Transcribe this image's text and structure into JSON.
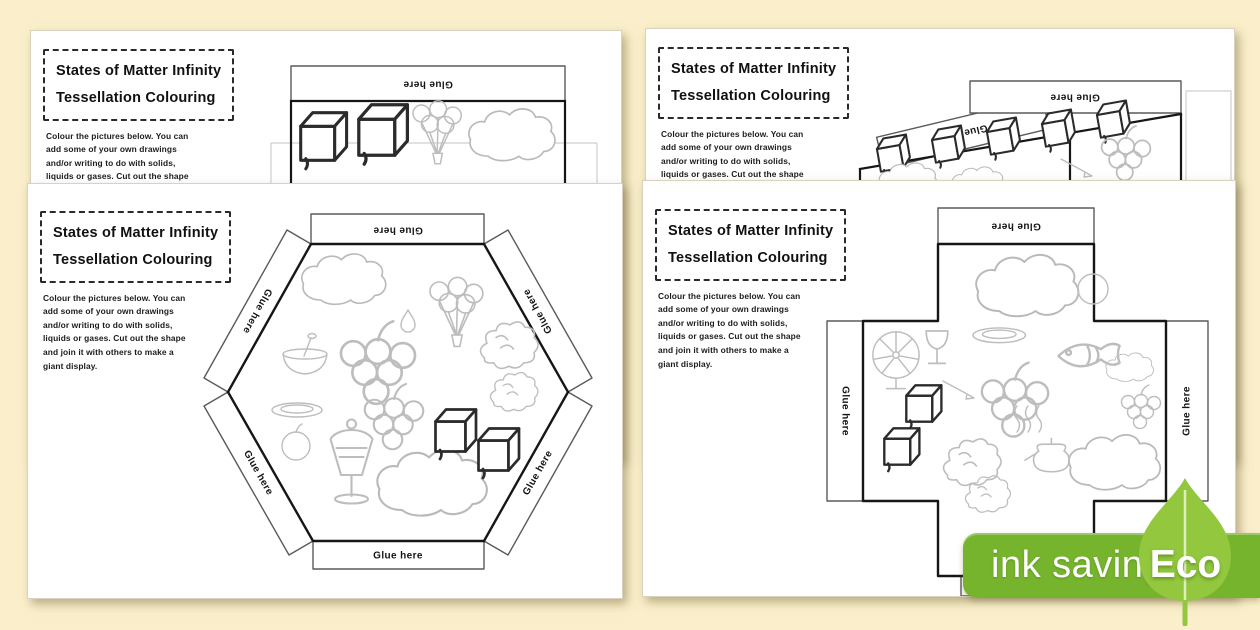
{
  "canvas": {
    "background_color": "#faefca"
  },
  "sheet": {
    "title_line1": "States of Matter Infinity",
    "title_line2": "Tessellation Colouring",
    "instructions": [
      "Colour the pictures below. You can",
      "add some of your own drawings",
      "and/or writing to do with solids,",
      "liquids or gases. Cut out the shape",
      "and join it with others to make a",
      "giant display."
    ],
    "glue_tab_label": "Glue here"
  },
  "badge": {
    "ink_saving_label": "ink saving",
    "eco_label": "Eco",
    "bar_color": "#76b42e",
    "leaf_color": "#92c73e"
  }
}
